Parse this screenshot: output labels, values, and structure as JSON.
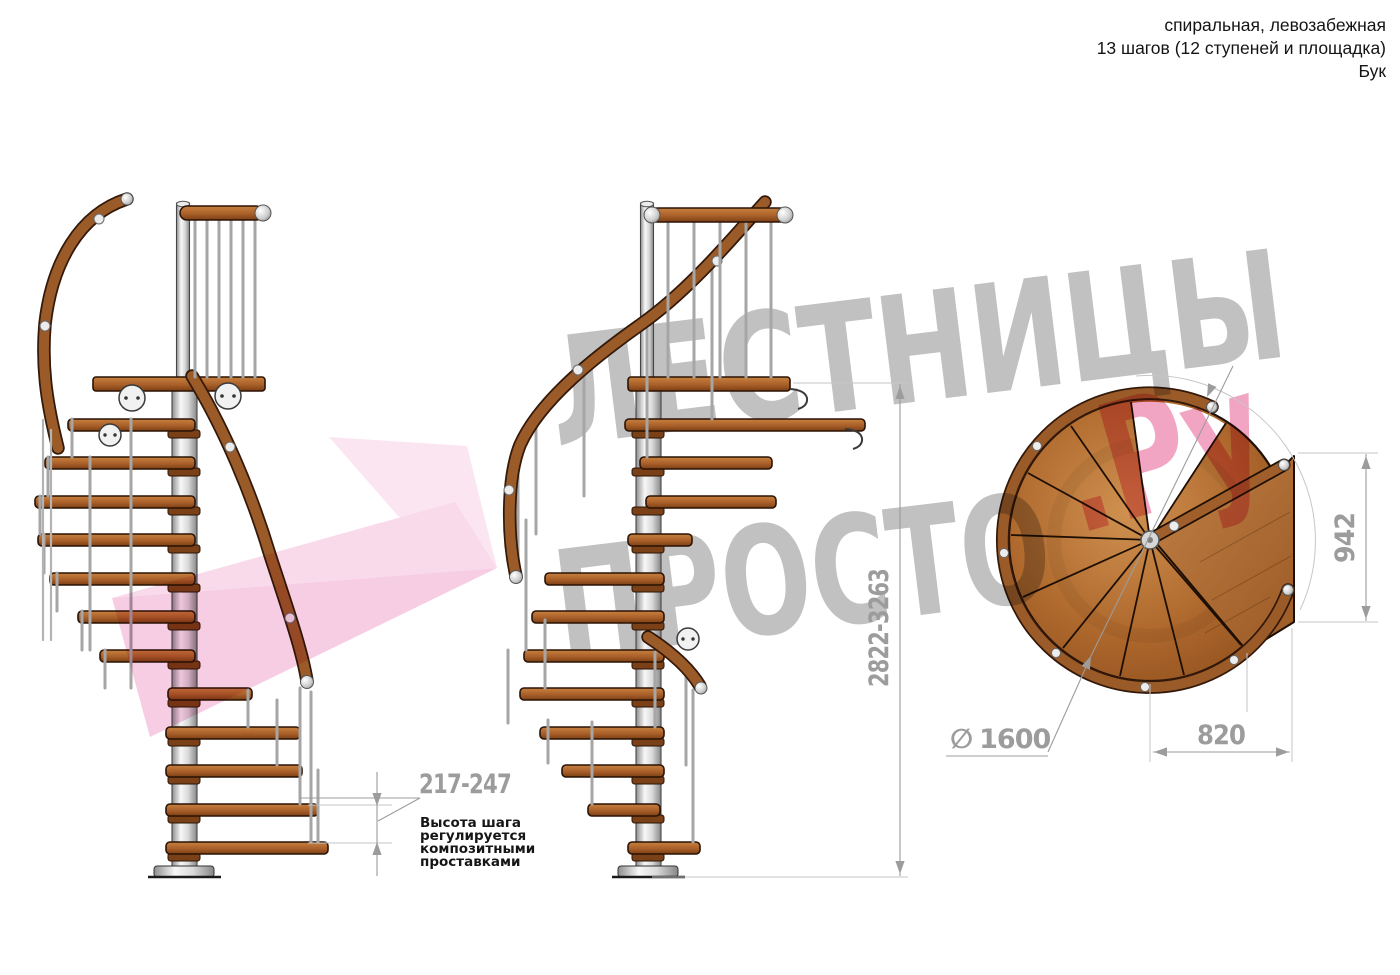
{
  "header": {
    "line1": "спиральная, левозабежная",
    "line2": "13 шагов (12 ступеней и площадка)",
    "line3": "Бук"
  },
  "watermark": {
    "word_top": "ЛЕСТНИЦЫ",
    "word_bottom": "ПРОСТО",
    "suffix": ".Ру"
  },
  "dimensions": {
    "step_height": "217-247",
    "step_note_lines": [
      "Высота шага",
      "регулируется",
      "композитными",
      "проставками"
    ],
    "total_height": "2822-3263",
    "landing_depth": "942",
    "landing_width": "820",
    "diameter_symbol": "∅",
    "diameter_value": "1600"
  },
  "colors": {
    "wood": "#a4642e",
    "wood_dark": "#7a4017",
    "metal": "#d9d9d9",
    "dimension_gray": "#9c9c9c",
    "annotation_black": "#161616",
    "watermark_gray": "#9a9a9a",
    "watermark_pink": "#e75e92",
    "logo_pink": "#f3b0d5"
  }
}
